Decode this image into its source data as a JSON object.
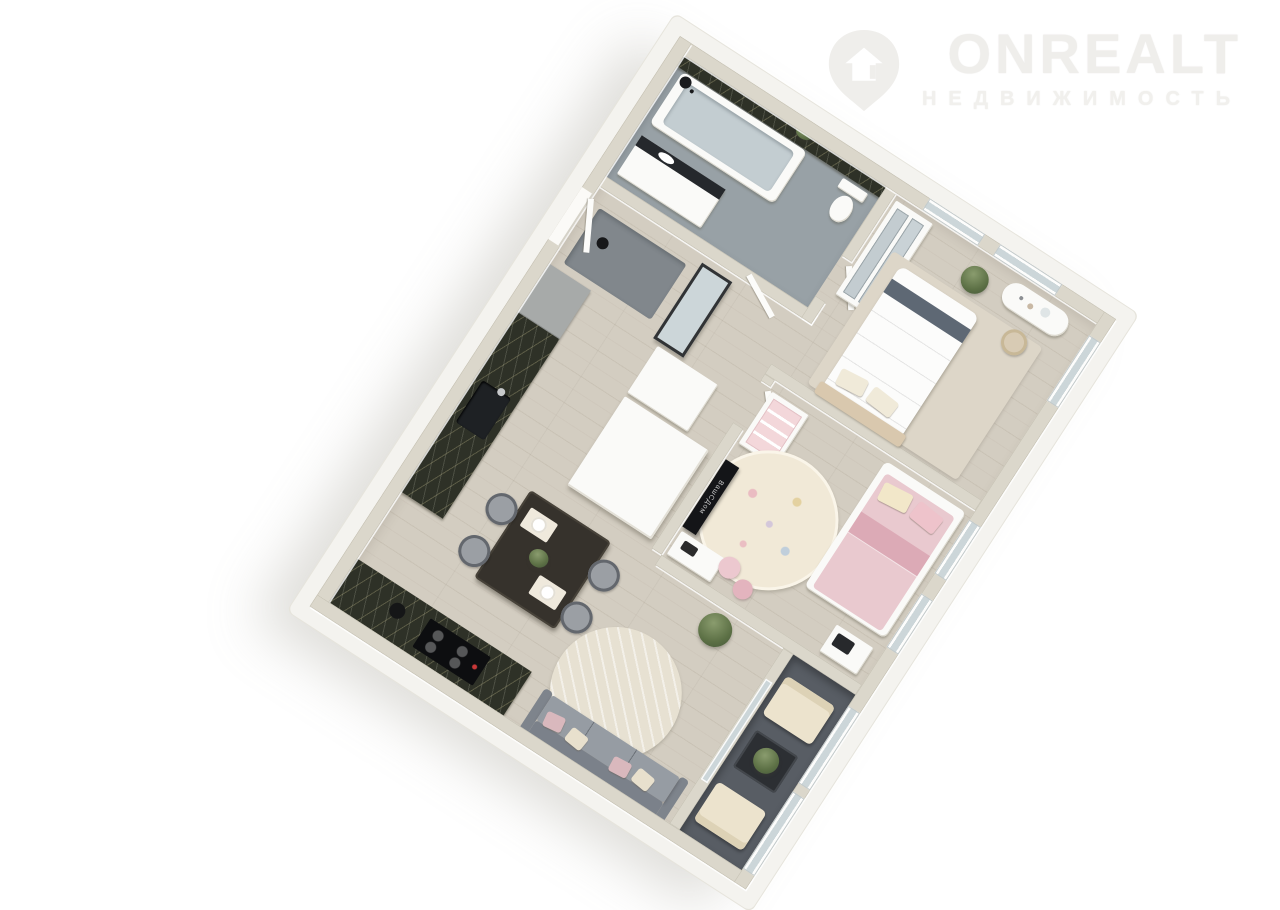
{
  "watermark": {
    "brand": "ONREALT",
    "tagline": "НЕДВИЖИМОСТЬ",
    "icon": "house-pin-icon"
  },
  "tv": {
    "watermark_text": "ВашСДом"
  },
  "palette": {
    "logo": "#efeeeb",
    "logo2": "#f1f0ed",
    "shellWhite": "#f4f3ef",
    "wallTop": "#dbd7cb",
    "wood": "#d3cdc1",
    "wood2": "#c9c2b5",
    "tile": "#98a1a6",
    "balconyFloor": "#585d64",
    "glass": "#ccd6d9",
    "marbleBase": "#2e3127",
    "white": "#fafaf8",
    "gray": "#a7aaa9",
    "mat": "#81878c",
    "chairGray": "#9b9fa4",
    "chairRing": "#63676d",
    "tableDark": "#36322c",
    "sofa": "#8e939a",
    "sofaBack": "#7b818a",
    "sofaSeat": "#969ca3",
    "duvet": "#fcfcfb",
    "bedStripe": "#5e6874",
    "headboardBeige": "#d9c8ae",
    "bedPink": "#e9c9cf",
    "bedPinkDark": "#dcaab6",
    "rugBedroom": "#ddd6c8",
    "rugCream": "#e7e1d2",
    "rugChild": "#f1e9d7",
    "cream": "#ece3cd",
    "blush": "#d9b8bd",
    "black": "#141518"
  },
  "scene": {
    "type": "3d-floorplan-render",
    "rotation_deg": 33,
    "rooms": [
      {
        "name": "bathroom",
        "furniture": [
          "bathtub",
          "shower-head",
          "toilet",
          "sink-vanity",
          "marble-accent-wall",
          "plant"
        ]
      },
      {
        "name": "hallway",
        "furniture": [
          "entrance-door",
          "floor-mat",
          "standing-mirror",
          "chest",
          "wardrobe-cabinet"
        ]
      },
      {
        "name": "master-bedroom",
        "furniture": [
          "double-bed",
          "mirror-wardrobe",
          "vanity-table",
          "stool",
          "area-rug",
          "plant",
          "two-top-windows",
          "side-window"
        ]
      },
      {
        "name": "kids-room",
        "furniture": [
          "pink-single-bed",
          "bookshelf",
          "tv",
          "tv-stand",
          "round-rug",
          "floor-cushions",
          "bench",
          "two-side-windows"
        ]
      },
      {
        "name": "living-dining-kitchen",
        "furniture": [
          "marble-counter-left",
          "marble-counter-bottom",
          "fridge",
          "cooktop",
          "kitchen-sink",
          "dining-table",
          "four-chairs",
          "sofa",
          "round-rug",
          "plant"
        ]
      },
      {
        "name": "balcony",
        "furniture": [
          "armchair-top",
          "armchair-bottom",
          "coffee-table",
          "plant",
          "glass-railing"
        ]
      }
    ]
  }
}
